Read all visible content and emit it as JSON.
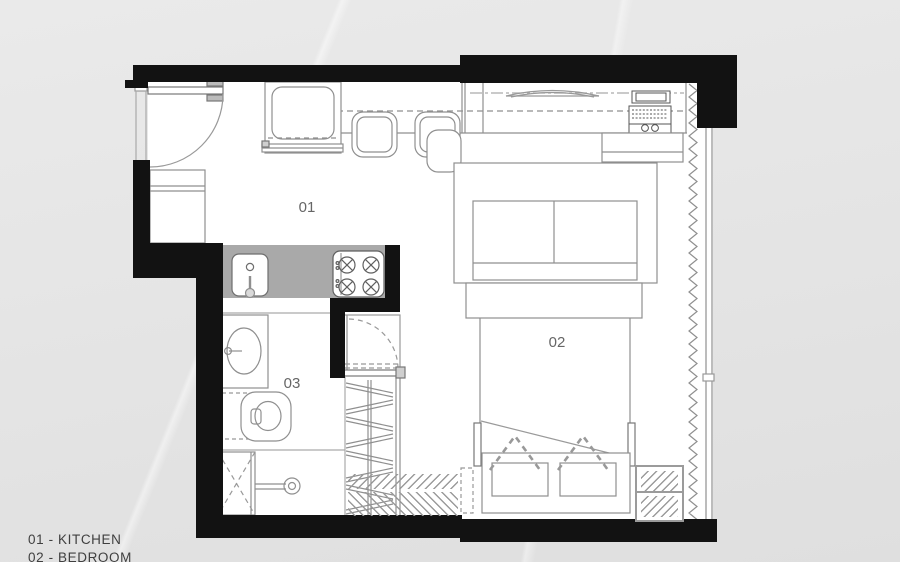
{
  "plan": {
    "title": "studio-apartment-floor-plan",
    "rooms": {
      "kitchen": {
        "number": "01",
        "name": "KITCHEN"
      },
      "bedroom": {
        "number": "02",
        "name": "BEDROOM"
      },
      "bathroom": {
        "number": "03",
        "name": ""
      }
    },
    "fixtures": [
      "entry-door",
      "shoe-cabinet",
      "refrigerator",
      "bar-stool",
      "bar-stool",
      "counter",
      "laptop",
      "shelf-tray",
      "desk-chair",
      "kitchen-sink",
      "cooktop-4-burners",
      "bed-with-pillows",
      "foot-bench",
      "rug",
      "wardrobe-hanging-rail",
      "floor-mat",
      "bathroom-door",
      "bathroom-sink",
      "toilet",
      "shower",
      "shower-head",
      "curtain-zigzag",
      "window-wall"
    ]
  },
  "legend": {
    "items": [
      {
        "label": "01 - KITCHEN"
      },
      {
        "label": "02 - BEDROOM"
      }
    ]
  },
  "colors": {
    "background": "#e6e6e6",
    "wall": "#121212",
    "counter_top": "#a9a9a9",
    "fixture_line": "#8f8f8f",
    "room_label": "#666666",
    "legend_text": "#3f3f3f"
  }
}
